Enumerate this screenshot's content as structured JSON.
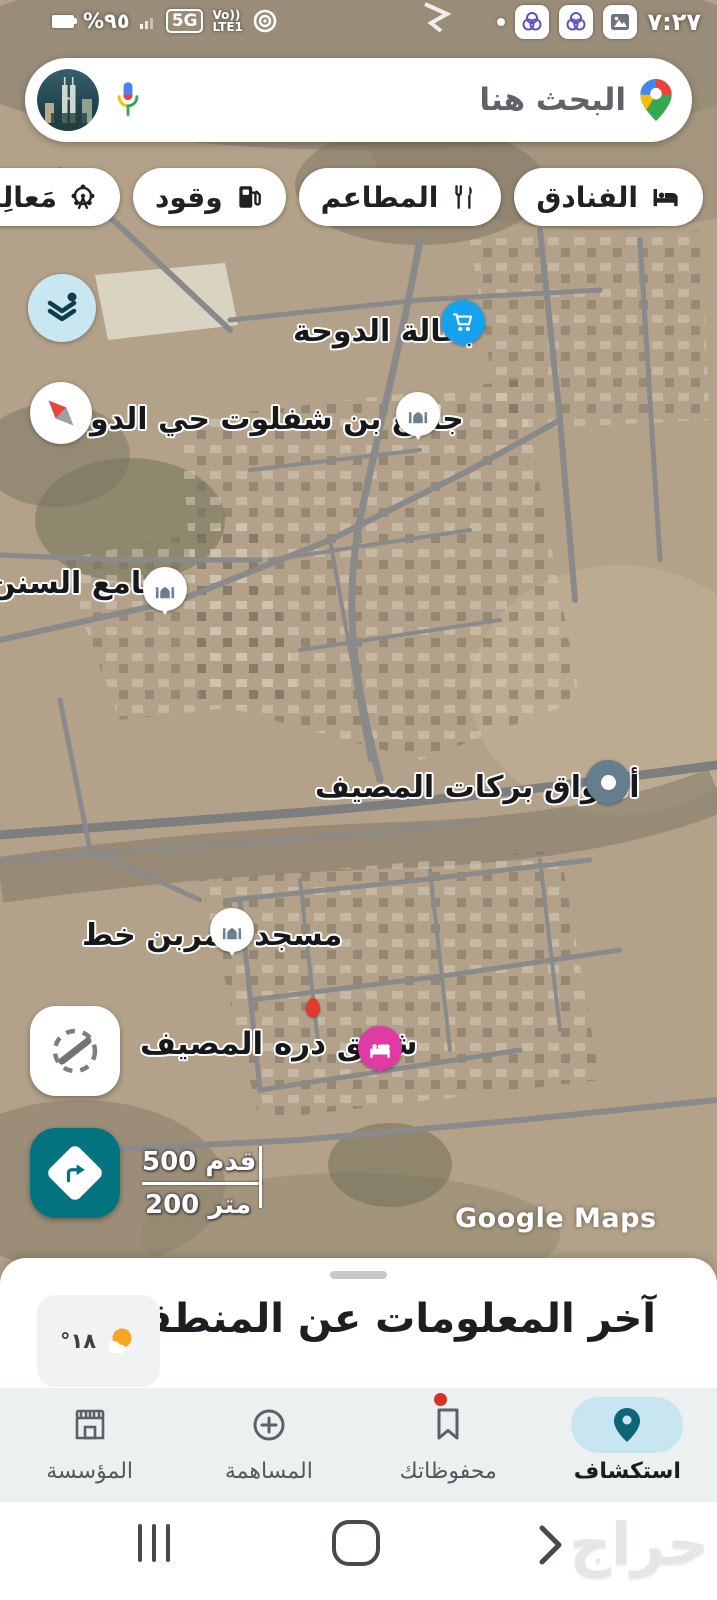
{
  "status_bar": {
    "battery_percent": "%٩٥",
    "network_badge": "5G",
    "volte_label": "Vo))",
    "lte_label": "LTE1",
    "time": "٧:٢٧"
  },
  "search": {
    "placeholder": "البحث هنا"
  },
  "chips": {
    "items": [
      {
        "label": "الفنادق",
        "icon": "hotel-bed-icon"
      },
      {
        "label": "المطاعم",
        "icon": "restaurant-icon"
      },
      {
        "label": "وقود",
        "icon": "fuel-pump-icon"
      },
      {
        "label": "مَعالِم",
        "icon": "attractions-icon"
      }
    ]
  },
  "map": {
    "labels": [
      {
        "text": "بقالة الدوحة",
        "pin": "grocery-cart-pin"
      },
      {
        "text": "جامع بن شفلوت حي الدو",
        "pin": "mosque-pin"
      },
      {
        "text": "جامع السنن",
        "pin": "mosque-pin"
      },
      {
        "text": "أسواق بركات المصيف",
        "pin": "place-dot-pin"
      },
      {
        "text": "مسجد عمربن خط",
        "pin": "mosque-pin"
      },
      {
        "text": "شقق دره المصيف",
        "pin": "hotel-bed-pin"
      }
    ],
    "scale": {
      "feet": "500 قدم",
      "meters": "200 متر"
    },
    "watermark": "Google Maps"
  },
  "sheet": {
    "title": "آخر المعلومات عن المنطقة",
    "temperature": "١٨°"
  },
  "bottom_nav": {
    "items": [
      {
        "label": "استكشاف",
        "active": true,
        "icon": "explore-pin-icon"
      },
      {
        "label": "محفوظاتك",
        "badge": true,
        "icon": "bookmark-icon"
      },
      {
        "label": "المساهمة",
        "icon": "contribute-plus-icon"
      },
      {
        "label": "المؤسسة",
        "icon": "business-storefront-icon"
      }
    ]
  },
  "android_nav": {
    "watermark": "حراج"
  },
  "colors": {
    "accent_teal": "#02737f",
    "active_pill_blue": "#c7e6f1",
    "layers_button_blue": "#c9e7f1",
    "pin_blue": "#17a2ef",
    "pin_pink": "#e23aa4",
    "pin_slate": "#647e8e",
    "badge_red": "#d93025"
  }
}
